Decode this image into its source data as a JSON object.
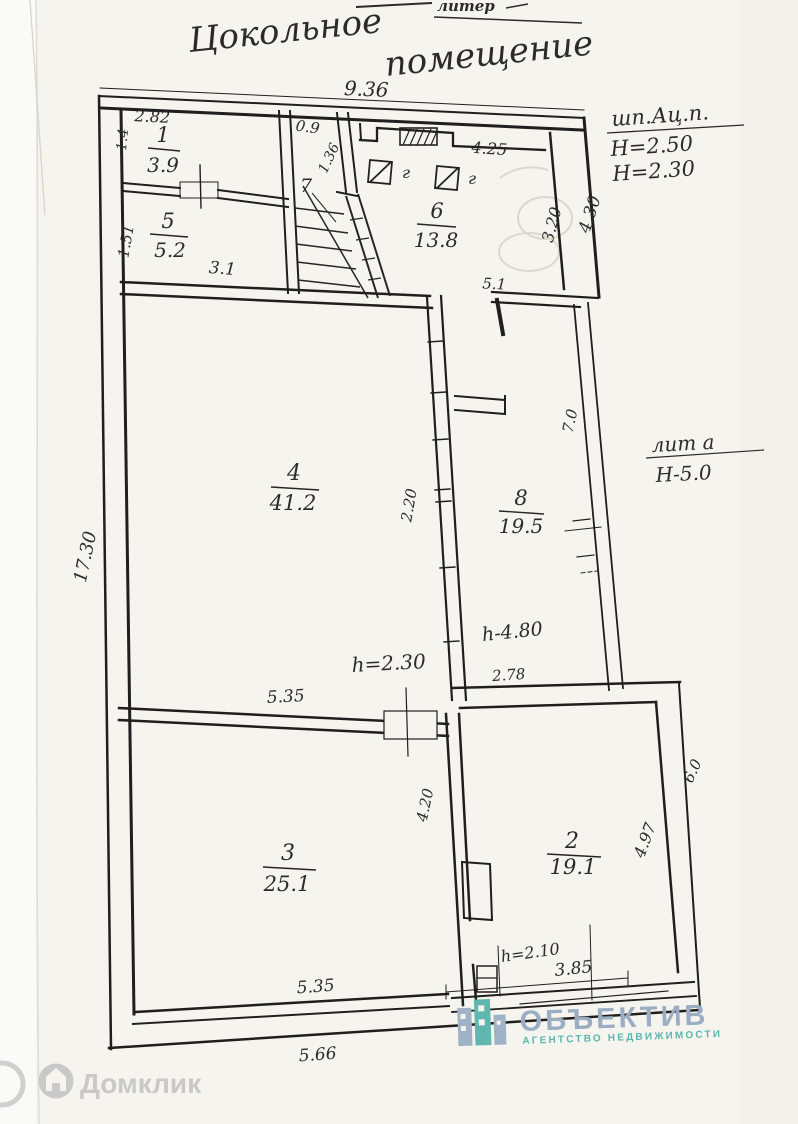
{
  "page": {
    "title_word1": "Цокольное",
    "title_word2": "помещение",
    "corner_note": "литер"
  },
  "notes": {
    "material": "шп.Ац.п.",
    "height1": "Н=2.50",
    "height2": "Н=2.30",
    "liter": "лит а",
    "liter_height": "Н-5.0"
  },
  "rooms": {
    "r1": {
      "num": "1",
      "area": "3.9"
    },
    "r5": {
      "num": "5",
      "area": "5.2"
    },
    "r6": {
      "num": "6",
      "area": "13.8"
    },
    "r7": {
      "num": "7"
    },
    "r4": {
      "num": "4",
      "area": "41.2"
    },
    "r8": {
      "num": "8",
      "area": "19.5"
    },
    "r3": {
      "num": "3",
      "area": "25.1"
    },
    "r2": {
      "num": "2",
      "area": "19.1"
    }
  },
  "dims": {
    "w_total": "9.36",
    "r1_w": "2.82",
    "r1_h": "1.4",
    "r5_h": "1.51",
    "r5_w": "3.1",
    "stair_w": "0.9",
    "stair_l": "1.36",
    "r6_w": "4.25",
    "r6_h": "3.20",
    "right_top": "4.30",
    "step_top": "5.1",
    "left_total": "17.30",
    "opening": "2.20",
    "r8_l": "7.0",
    "r8_w": "2.78",
    "h_mid": "h-4.80",
    "h_door": "h=2.30",
    "r3_w_top": "5.35",
    "div_h": "4.20",
    "r2_h": "4.97",
    "r2_right": "6.0",
    "h_r2": "h=2.10",
    "r2_w": "3.85",
    "r3_w_bot": "5.35",
    "bottom_out": "5.66"
  },
  "symbols": {
    "gas": "г"
  },
  "watermarks": {
    "domclick": "Домклик",
    "agency_name": "ОБЪЕКТИВ",
    "agency_sub": "АГЕНТСТВО НЕДВИЖИМОСТИ"
  },
  "colors": {
    "ink": "#232323",
    "paper": "#f6f4ef",
    "domclick_grey": "#c9c9c9",
    "agency_blue": "#9aadc2",
    "agency_teal": "#5cb6ae"
  }
}
